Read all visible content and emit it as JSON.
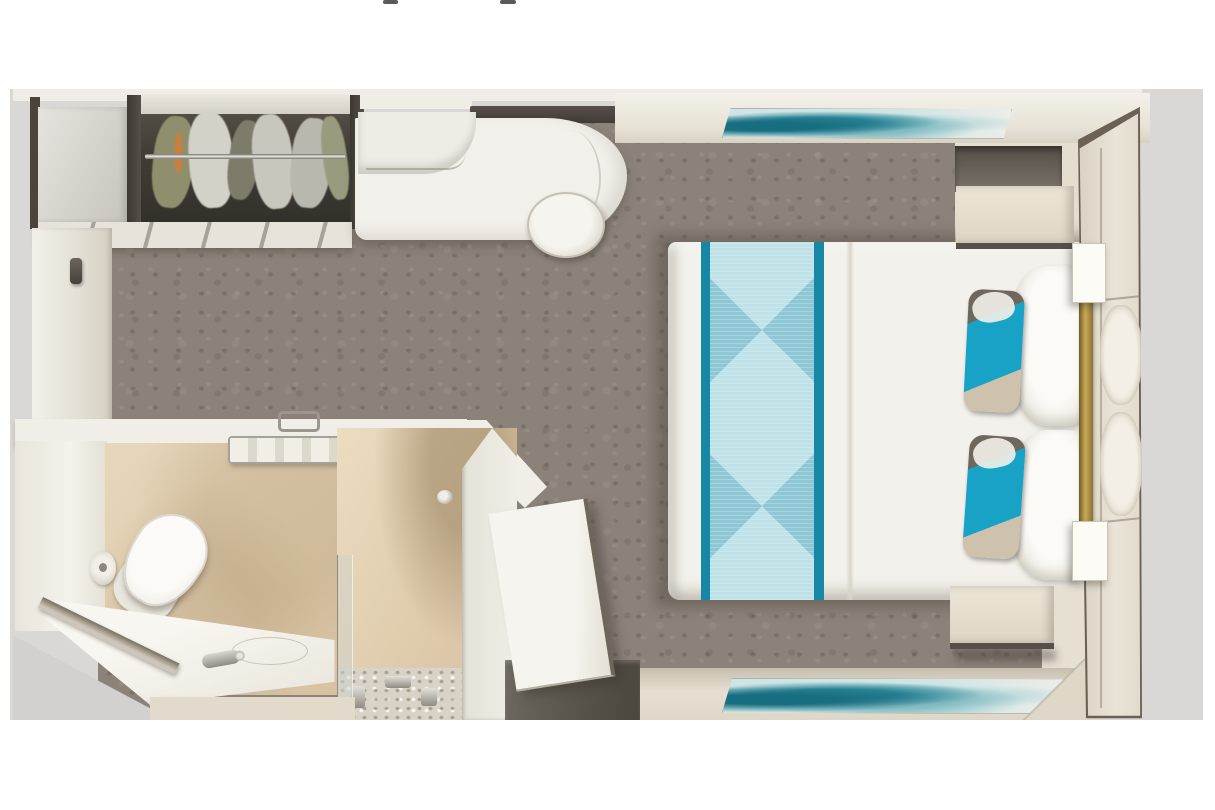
{
  "meta": {
    "description": "Top-down 3D rendered floor plan of a cruise ship interior stateroom on a light gray card; no UI text visible, only two tiny cropped text descender marks at the very top edge",
    "view": "overhead cutaway"
  },
  "palette": {
    "page-bg": "#ffffff",
    "panel-bg": "#d9d8d6",
    "carpet": "#8b8279",
    "wall-light": "#efede6",
    "wall-beige": "#e6e0d2",
    "wood-dark": "#4a443c",
    "desk-white": "#f2f0ea",
    "bed-white": "#f3f1eb",
    "runner-teal": "#1787a6",
    "runner-light": "#aad4df",
    "accent-cyan": "#18a2c6",
    "accent-tan": "#cfc2ac",
    "gold": "#b89a4e",
    "nightstand": "#e8e2d4",
    "art-teal": "#1e7b8c",
    "bath-floor": "#e7d7bb",
    "porcelain": "#f7f5f0",
    "mosaic": "#d9d3c7",
    "threshold": "#5f5953"
  },
  "elements": {
    "stage": "Cruise stateroom floor plan render",
    "panel": "Light gray image card",
    "remnant_left": "Cropped text descender mark",
    "remnant_right": "Cropped text descender mark",
    "carpet": "Mottled taupe carpet",
    "wardrobe": "Wardrobe with hanging clothes",
    "clothes_rail": "Chrome clothes rail",
    "shelf_tower": "Open shelf cabinet",
    "shelf_strip": "Closet lower shelf front",
    "left_wall": "Left cabin wall",
    "wall_handle": "Wall handle",
    "desk": "Curved vanity desk",
    "desk_shelf": "Dark shelf above desk",
    "drawer_unit": "Desk drawer unit",
    "stool": "Round stool",
    "top_wall": "Upper cabin wall",
    "artwork_top": "Teal abstract artwork (upper wall)",
    "artwork_bottom": "Teal abstract artwork (lower wall)",
    "storage_niche": "Recessed dark storage niche",
    "bed": "Double bed with white duvet",
    "bed_runner": "Teal diamond-pattern bed runner",
    "pillow": "White pillow",
    "accent_pillow": "Teal accent pillow",
    "nightstand_top": "Nightstand (upper)",
    "nightstand_bottom": "Nightstand (lower)",
    "headboard_wall": "Paneled headboard wall",
    "headboard_cushion": "Tufted headboard cushion",
    "gold_trim": "Brass trim strip",
    "sconce": "Wall sconce light",
    "bathroom": "Bathroom",
    "bath_floor": "Beige marble bathroom floor",
    "toilet": "Toilet",
    "toilet_paper": "Toilet paper holder",
    "towel_rack": "Chrome towel rack with towels",
    "vanity": "Washbasin counter",
    "basin": "Washbasin",
    "faucet": "Chrome faucet",
    "shower": "Shower enclosure",
    "shower_glass": "Shower glass door",
    "mosaic_floor": "Mosaic shower floor",
    "valve": "Shower control valve",
    "entry_door": "Cabin entry door (open leaf)",
    "threshold": "Entry threshold floor",
    "exterior_wedge": "Area outside angled hull wall"
  }
}
